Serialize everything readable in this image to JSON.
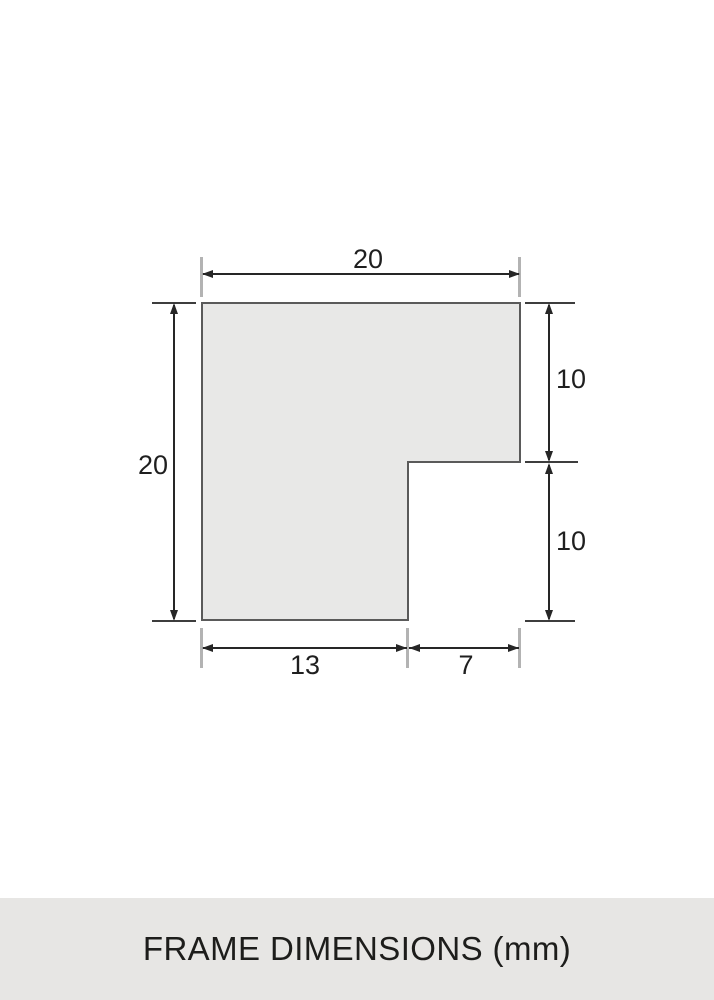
{
  "diagram": {
    "dimensions": {
      "top_width": "20",
      "left_height": "20",
      "right_upper": "10",
      "right_lower": "10",
      "bottom_left": "13",
      "bottom_right": "7"
    }
  },
  "caption": {
    "text": "FRAME DIMENSIONS (mm)"
  },
  "colors": {
    "page-bg": "#ffffff",
    "shape-fill": "#e8e8e7",
    "shape-border": "#5a5a5a",
    "dim-line": "#262626",
    "ext-line": "#b3b3b3",
    "tick-line": "#3d3d3d",
    "label-text": "#1f1f1f",
    "footer-bg": "#e7e6e4",
    "caption-text": "#1d1d1b"
  }
}
